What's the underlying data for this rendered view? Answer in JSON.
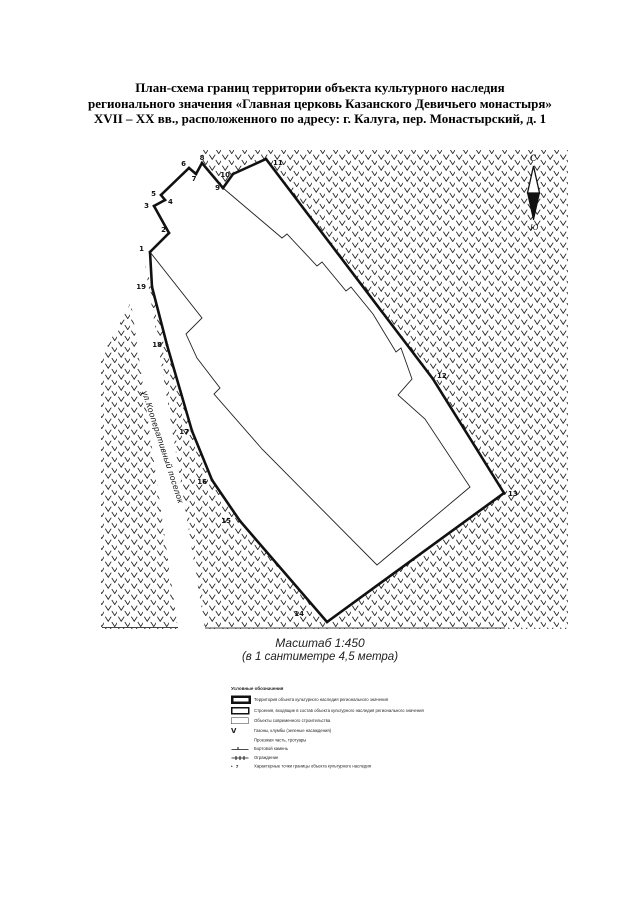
{
  "title": {
    "lines": [
      "План-схема границ территории объекта культурного наследия",
      "регионального значения «Главная церковь Казанского Девичьего монастыря»",
      "XVII – XX вв., расположенного по адресу: г. Калуга, пер. Монастырский, д. 1"
    ]
  },
  "map": {
    "street_label": "ул.Кооперативный поселок",
    "compass": {
      "north": "С",
      "south": "Ю"
    },
    "boundary_points": [
      {
        "n": "1",
        "x": 150,
        "y": 252,
        "lx": 144,
        "ly": 251,
        "anchor": "end"
      },
      {
        "n": "2",
        "x": 169,
        "y": 233,
        "lx": 166,
        "ly": 232,
        "anchor": "end"
      },
      {
        "n": "3",
        "x": 154,
        "y": 206,
        "lx": 149,
        "ly": 208,
        "anchor": "end"
      },
      {
        "n": "4",
        "x": 165,
        "y": 200,
        "lx": 168,
        "ly": 204,
        "anchor": "start"
      },
      {
        "n": "5",
        "x": 161,
        "y": 195,
        "lx": 156,
        "ly": 196,
        "anchor": "end"
      },
      {
        "n": "6",
        "x": 189,
        "y": 168,
        "lx": 186,
        "ly": 166,
        "anchor": "end"
      },
      {
        "n": "7",
        "x": 196,
        "y": 174,
        "lx": 194,
        "ly": 181,
        "anchor": "middle"
      },
      {
        "n": "8",
        "x": 202,
        "y": 163,
        "lx": 202,
        "ly": 160,
        "anchor": "middle"
      },
      {
        "n": "9",
        "x": 223,
        "y": 188,
        "lx": 220,
        "ly": 190,
        "anchor": "end"
      },
      {
        "n": "10",
        "x": 233,
        "y": 174,
        "lx": 230,
        "ly": 177,
        "anchor": "end"
      },
      {
        "n": "11",
        "x": 266,
        "y": 159,
        "lx": 273,
        "ly": 165,
        "anchor": "start"
      },
      {
        "n": "12",
        "x": 433,
        "y": 379,
        "lx": 437,
        "ly": 378,
        "anchor": "start"
      },
      {
        "n": "13",
        "x": 504,
        "y": 493,
        "lx": 508,
        "ly": 496,
        "anchor": "start"
      },
      {
        "n": "14",
        "x": 327,
        "y": 622,
        "lx": 304,
        "ly": 616,
        "anchor": "end"
      },
      {
        "n": "15",
        "x": 240,
        "y": 521,
        "lx": 231,
        "ly": 523,
        "anchor": "end"
      },
      {
        "n": "16",
        "x": 212,
        "y": 480,
        "lx": 207,
        "ly": 484,
        "anchor": "end"
      },
      {
        "n": "17",
        "x": 192,
        "y": 431,
        "lx": 189,
        "ly": 434,
        "anchor": "end"
      },
      {
        "n": "18",
        "x": 167,
        "y": 345,
        "lx": 162,
        "ly": 347,
        "anchor": "end"
      },
      {
        "n": "19",
        "x": 152,
        "y": 287,
        "lx": 146,
        "ly": 289,
        "anchor": "end"
      }
    ],
    "building_outline": [
      [
        223,
        188
      ],
      [
        282,
        238
      ],
      [
        287,
        234
      ],
      [
        317,
        266
      ],
      [
        322,
        262
      ],
      [
        346,
        291
      ],
      [
        351,
        287
      ],
      [
        373,
        314
      ],
      [
        396,
        352
      ],
      [
        401,
        348
      ],
      [
        412,
        379
      ],
      [
        398,
        395
      ],
      [
        425,
        419
      ],
      [
        470,
        487
      ],
      [
        377,
        565
      ],
      [
        262,
        449
      ],
      [
        214,
        394
      ],
      [
        220,
        388
      ],
      [
        197,
        358
      ],
      [
        186,
        334
      ],
      [
        202,
        318
      ],
      [
        150,
        252
      ]
    ],
    "hatch_regions": [
      [
        [
          202,
          150
        ],
        [
          568,
          150
        ],
        [
          568,
          629
        ],
        [
          333,
          629
        ],
        [
          327,
          622
        ],
        [
          504,
          493
        ],
        [
          433,
          379
        ],
        [
          266,
          159
        ],
        [
          233,
          175
        ],
        [
          223,
          188
        ],
        [
          202,
          163
        ]
      ],
      [
        [
          145,
          265
        ],
        [
          152,
          287
        ],
        [
          167,
          345
        ],
        [
          192,
          431
        ],
        [
          212,
          480
        ],
        [
          240,
          521
        ],
        [
          327,
          622
        ],
        [
          331,
          629
        ],
        [
          205,
          629
        ]
      ],
      [
        [
          101,
          358
        ],
        [
          131,
          302
        ],
        [
          178,
          629
        ],
        [
          101,
          629
        ]
      ]
    ],
    "bottom_lines": [
      [
        102,
        627.5,
        178,
        627.5
      ],
      [
        205,
        628,
        505,
        628
      ]
    ],
    "street_label_pos": {
      "x": 142,
      "y": 392,
      "angle": 72
    },
    "compass_pos": {
      "cx": 533.5,
      "label_n_x": 530,
      "label_n_y": 161,
      "tip_top": 166,
      "mid": 193,
      "half_w": 6,
      "tip_bottom": 220,
      "label_s_x": 530,
      "label_s_y": 230
    }
  },
  "scale": {
    "line1": "Масштаб 1:450",
    "line2": "(в 1 сантиметре 4,5 метра)"
  },
  "legend": {
    "title": "Условные обозначения",
    "items": [
      {
        "symbol": "territory",
        "label": "Территория объекта культурного наследия регионального значения"
      },
      {
        "symbol": "building",
        "label": "Строения, входящие в состав объекта культурного наследия регионального значения"
      },
      {
        "symbol": "modern",
        "label": "Объекты современного строительства"
      },
      {
        "symbol": "lawn",
        "label": "Газоны, клумбы (зеленые насаждения)"
      },
      {
        "symbol": "roadway",
        "label": "Проезжая часть, тротуары"
      },
      {
        "symbol": "curb",
        "label": "Бортовой камень"
      },
      {
        "symbol": "fence",
        "label": "Ограждение"
      },
      {
        "symbol": "point",
        "label": "Характерные точки границы объекта культурного наследия"
      }
    ],
    "point_symbol_number": "7",
    "lawn_glyph": "V"
  }
}
